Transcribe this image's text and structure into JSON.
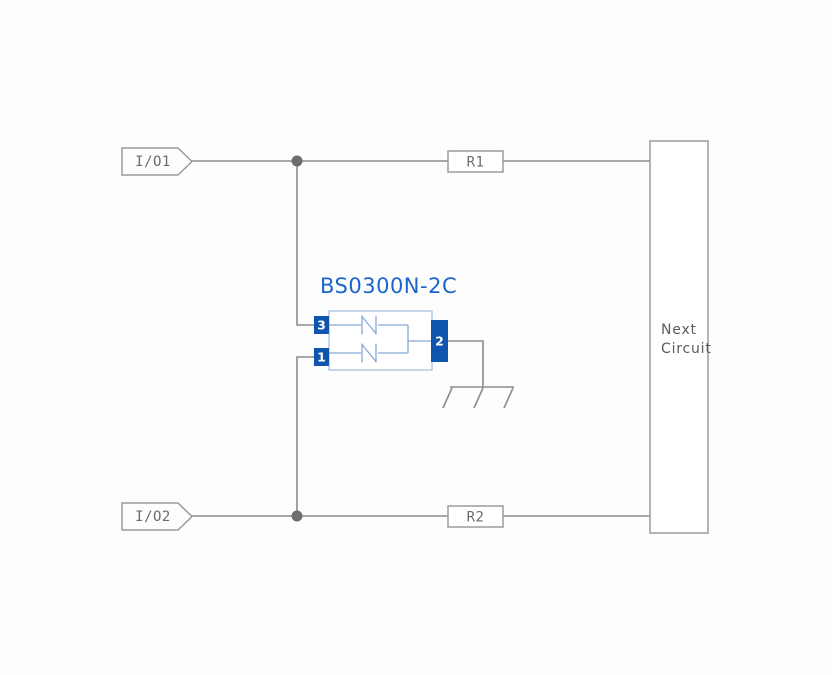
{
  "diagram": {
    "component": {
      "title": "BS0300N-2C",
      "pins": {
        "top_left": "3",
        "bottom_left": "1",
        "right": "2"
      }
    },
    "ports": {
      "io1": "I/O1",
      "io2": "I/O2"
    },
    "resistors": {
      "r1": "R1",
      "r2": "R2"
    },
    "next_circuit": {
      "line1": "Next",
      "line2": "Circuit"
    },
    "colors": {
      "background": "#fdfdfd",
      "wire_gray": "#8b8b8b",
      "box_border_gray": "#9b9b9b",
      "label_gray": "#6b6b6b",
      "junction_gray": "#6d6d6d",
      "title_blue": "#1b65cc",
      "pin_blue": "#0f55ae",
      "body_border_blue": "#a7c0e0",
      "inner_wire_blue": "#84a8d4",
      "pin_text": "#ffffff"
    }
  }
}
